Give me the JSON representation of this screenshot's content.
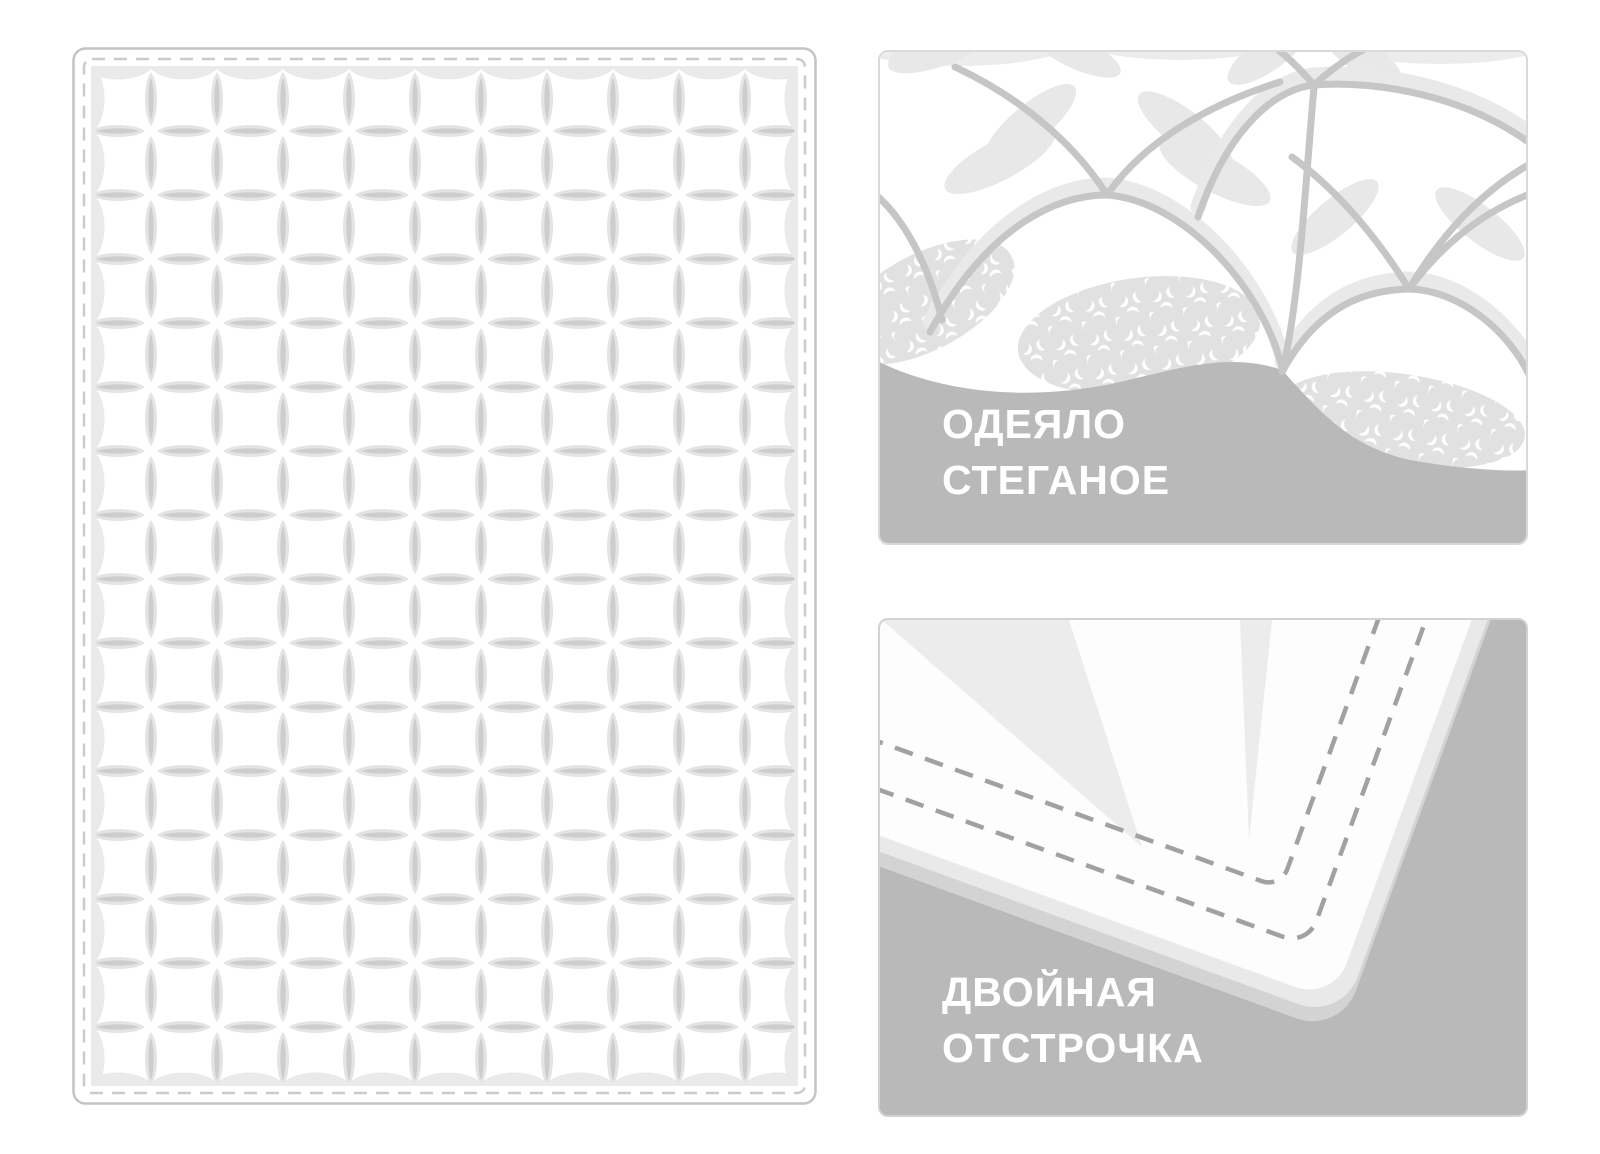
{
  "illustration": {
    "subject": "quilted blanket product features",
    "callouts": {
      "quilted_blanket": {
        "line1": "ОДЕЯЛО",
        "line2": "СТЕГАНОЕ"
      },
      "double_stitching": {
        "line1": "ДВОЙНАЯ",
        "line2": "ОТСТРОЧКА"
      }
    }
  },
  "colors": {
    "page_bg": "#ffffff",
    "gray_panel": "#b9b9b9",
    "label_text": "#ffffff",
    "panel_border": "#d9d9d9",
    "blanket_outline": "#c4c4c4",
    "stitch_dash": "#cbcbcb",
    "lens_fill": "#e4e4e4",
    "lens_core": "#cdcdcd",
    "seam": "#c6c6c6",
    "petal": "#e8e8e8",
    "print_bg": "#e1e1e1",
    "print_crescent": "#ffffff",
    "corner_dash": "#a1a1a1",
    "blanket_face": "#fdfdfd"
  }
}
